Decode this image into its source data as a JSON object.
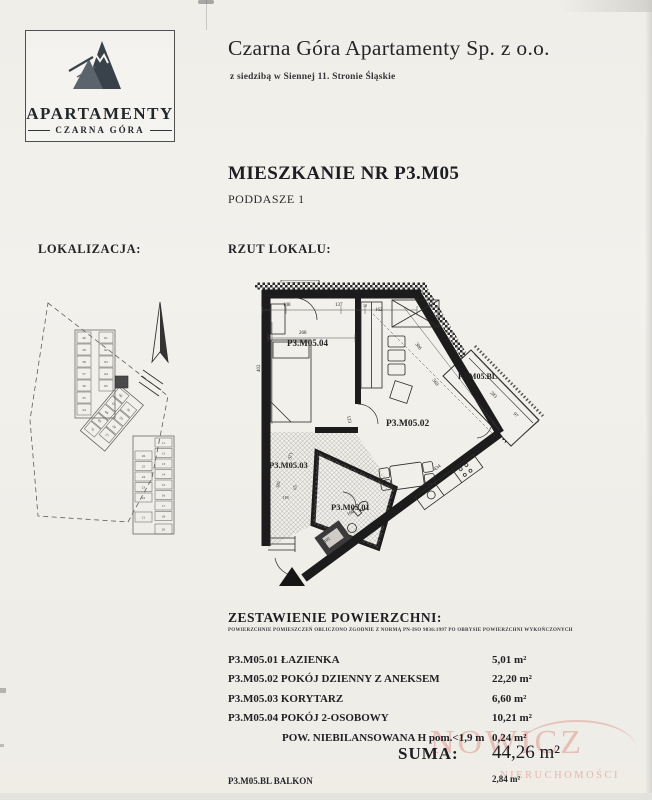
{
  "header": {
    "logo": {
      "line1": "APARTAMENTY",
      "line2": "CZARNA GÓRA",
      "icon": "mountain-logo"
    },
    "company": "Czarna Góra Apartamenty Sp. z o.o.",
    "address": "z siedzibą w Siennej 11. Stronie Śląskie"
  },
  "title": {
    "main": "MIESZKANIE NR P3.M05",
    "sub": "PODDASZE 1"
  },
  "labels": {
    "location": "LOKALIZACJA:",
    "plan": "RZUT LOKALU:"
  },
  "floor_plan": {
    "note": "H=60 cm n.p.p.",
    "rooms": [
      {
        "id": "P3.M05.04",
        "x": 32,
        "y": 66,
        "s": 9
      },
      {
        "id": "P3.M05.02",
        "x": 131,
        "y": 146,
        "s": 9.5
      },
      {
        "id": "P3.M05.03",
        "x": 14,
        "y": 188,
        "s": 8.5
      },
      {
        "id": "P3.M05.01",
        "x": 76,
        "y": 230,
        "s": 8.5
      },
      {
        "id": "P3.M05.BL",
        "x": 203,
        "y": 99,
        "s": 8
      }
    ],
    "dims": [
      {
        "t": "23",
        "x": 6,
        "y": 26,
        "r": 0,
        "s": 5
      },
      {
        "t": "108",
        "x": 28,
        "y": 26,
        "r": 0,
        "s": 5
      },
      {
        "t": "137",
        "x": 80,
        "y": 26,
        "r": 0,
        "s": 5
      },
      {
        "t": "10",
        "x": 108,
        "y": 27,
        "r": 0,
        "s": 4
      },
      {
        "t": "162",
        "x": 120,
        "y": 31,
        "r": 0,
        "s": 5
      },
      {
        "t": "268",
        "x": 44,
        "y": 54,
        "r": 0,
        "s": 5
      },
      {
        "t": "402",
        "x": 5,
        "y": 92,
        "r": -90,
        "s": 5
      },
      {
        "t": "306",
        "x": 160,
        "y": 64,
        "r": 54,
        "s": 5
      },
      {
        "t": "569",
        "x": 177,
        "y": 100,
        "r": 54,
        "s": 5
      },
      {
        "t": "123",
        "x": 92,
        "y": 136,
        "r": 78,
        "s": 5
      },
      {
        "t": "283",
        "x": 235,
        "y": 113,
        "r": 46,
        "s": 5
      },
      {
        "t": "97",
        "x": 258,
        "y": 134,
        "r": 46,
        "s": 5
      },
      {
        "t": "371",
        "x": 36,
        "y": 180,
        "r": -76,
        "s": 5
      },
      {
        "t": "382",
        "x": 24,
        "y": 208,
        "r": -80,
        "s": 4.5
      },
      {
        "t": "65",
        "x": 41,
        "y": 210,
        "r": -80,
        "s": 4.5
      },
      {
        "t": "118",
        "x": 27,
        "y": 219,
        "r": 0,
        "s": 4.5
      },
      {
        "t": "141",
        "x": 10,
        "y": 250,
        "r": -78,
        "s": 5
      },
      {
        "t": "166",
        "x": 93,
        "y": 236,
        "r": -30,
        "s": 5
      },
      {
        "t": "434",
        "x": 180,
        "y": 191,
        "r": -36,
        "s": 5
      },
      {
        "t": "102",
        "x": 70,
        "y": 263,
        "r": -36,
        "s": 4.5
      },
      {
        "t": "H=60 cm n.p.p.",
        "x": 9,
        "y": 17,
        "r": 0,
        "s": 3.6
      }
    ]
  },
  "site_plan": {
    "units": {
      "upper_left": [
        "40",
        "39",
        "38",
        "37",
        "36",
        "35",
        "34"
      ],
      "upper_right": [
        "61",
        "62",
        "63",
        "64",
        "65"
      ],
      "mid_a": [
        "66",
        "67",
        "68",
        "69",
        "70"
      ],
      "mid_b": [
        "30",
        "29",
        "28",
        "27"
      ],
      "lower_left": [
        "26",
        "25",
        "24",
        "23",
        "22"
      ],
      "lower_right": [
        "11",
        "12",
        "13",
        "14",
        "15",
        "16",
        "17",
        "18"
      ],
      "bottom": [
        "21",
        "20"
      ]
    }
  },
  "areas": {
    "title": "ZESTAWIENIE POWIERZCHNI:",
    "subtitle": "POWIERZCHNIE POMIESZCZEŃ OBLICZONO ZGODNIE Z NORMĄ PN-ISO 9836:1997 PO OBRYSIE POWIERZCHNI WYKOŃCZONYCH",
    "rows": [
      {
        "label": "P3.M05.01 ŁAZIENKA",
        "value": "5,01 m²"
      },
      {
        "label": "P3.M05.02 POKÓJ DZIENNY Z ANEKSEM",
        "value": "22,20 m²"
      },
      {
        "label": "P3.M05.03 KORYTARZ",
        "value": "6,60 m²"
      },
      {
        "label": "P3.M05.04 POKÓJ 2-OSOBOWY",
        "value": "10,21 m²"
      },
      {
        "label": "POW. NIEBILANSOWANA H pom.<1,9 m",
        "value": "0,24 m²",
        "indent": true
      }
    ],
    "total_label": "SUMA:",
    "total_value": "44,26 m²",
    "balcony": {
      "label": "P3.M05.BL BALKON",
      "value": "2,84 m²"
    }
  },
  "watermark": {
    "line1": "NOWICZ",
    "line2": "NIERUCHOMOŚCI",
    "color": "#db8b83"
  }
}
